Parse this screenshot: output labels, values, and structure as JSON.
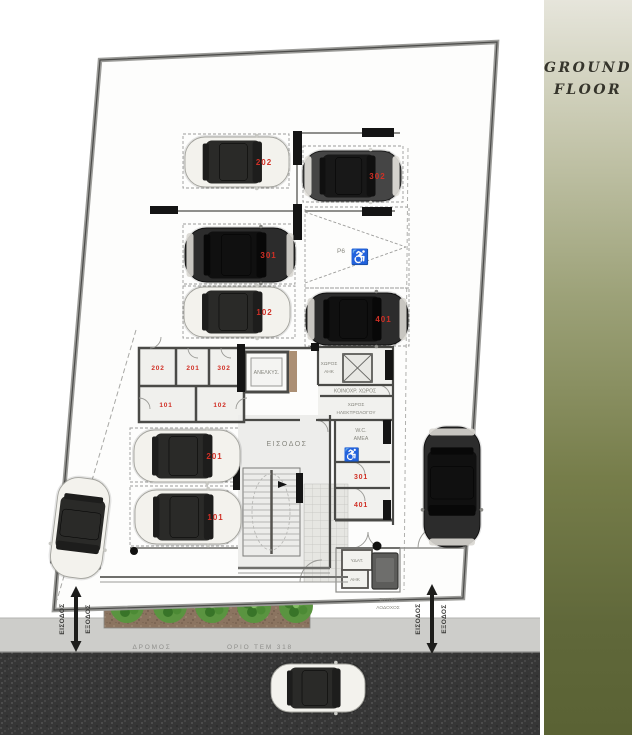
{
  "banner": {
    "line1": "GROUND",
    "line2": "FLOOR"
  },
  "plan": {
    "room_labels": {
      "elevator": "ΑΝΕΛΚΥΣ.",
      "entrance": "ΕΙΣΟΔΟΣ",
      "ahk1": "ΧΩΡΟΣ",
      "ahk2": "ΑΗΚ",
      "communal": "ΚΟΙΝΟΧΡ. ΧΩΡΟΣ",
      "electrician1": "ΧΩΡΟΣ",
      "electrician2": "ΗΛΕΚΤΡΟΛΟΓΟΥ",
      "wc1": "W.C.",
      "wc2": "ΑΜΕΑ",
      "water": "ΥΔΑΤ.",
      "ahk_small": "ΑΗΚ",
      "trash1": "ΣΚΥΒΑ-",
      "trash2": "ΛΟΔΟΧΟΣ",
      "store_right_upper": "301",
      "store_right_lower": "401",
      "accessible_space": "P6"
    },
    "accessible_icon": "♿",
    "storage_units": [
      {
        "label": "202",
        "x": 158,
        "y": 370
      },
      {
        "label": "201",
        "x": 193,
        "y": 370
      },
      {
        "label": "302",
        "x": 224,
        "y": 370
      },
      {
        "label": "101",
        "x": 166,
        "y": 407
      },
      {
        "label": "102",
        "x": 220,
        "y": 407
      }
    ],
    "cars": [
      {
        "label": "202",
        "cx": 237,
        "cy": 162,
        "len": 104,
        "wid": 50,
        "rot": 0,
        "style": "light"
      },
      {
        "label": "302",
        "cx": 352,
        "cy": 176,
        "len": 98,
        "wid": 50,
        "rot": 0,
        "style": "dark"
      },
      {
        "label": "301",
        "cx": 240,
        "cy": 255,
        "len": 110,
        "wid": 54,
        "rot": 0,
        "style": "black"
      },
      {
        "label": "102",
        "cx": 237,
        "cy": 312,
        "len": 106,
        "wid": 50,
        "rot": 0,
        "style": "light"
      },
      {
        "label": "401",
        "cx": 357,
        "cy": 319,
        "len": 102,
        "wid": 52,
        "rot": 0,
        "style": "black"
      },
      {
        "label": "201",
        "cx": 187,
        "cy": 456,
        "len": 106,
        "wid": 52,
        "rot": 0,
        "style": "light"
      },
      {
        "label": "101",
        "cx": 188,
        "cy": 517,
        "len": 106,
        "wid": 54,
        "rot": 0,
        "style": "light"
      },
      {
        "label": "",
        "cx": 452,
        "cy": 487,
        "len": 120,
        "wid": 56,
        "rot": 90,
        "style": "black"
      },
      {
        "label": "",
        "cx": 80,
        "cy": 528,
        "len": 100,
        "wid": 52,
        "rot": 97,
        "style": "light"
      },
      {
        "label": "",
        "cx": 318,
        "cy": 688,
        "len": 94,
        "wid": 48,
        "rot": 0,
        "style": "light"
      }
    ],
    "trees_x": [
      127,
      170,
      212,
      254,
      296
    ]
  },
  "street": {
    "road": "ΔΡΟΜΟΣ",
    "parcel": "ΟΡΙΟ ΤΕΜ 318",
    "in_label": "ΕΙΣΟΔΟΣ",
    "out_label": "ΕΞΟΔΟΣ"
  },
  "colors": {
    "unit_label": "#d03026",
    "accessible_blue": "#2f7fd0",
    "wall_black": "#141414"
  }
}
